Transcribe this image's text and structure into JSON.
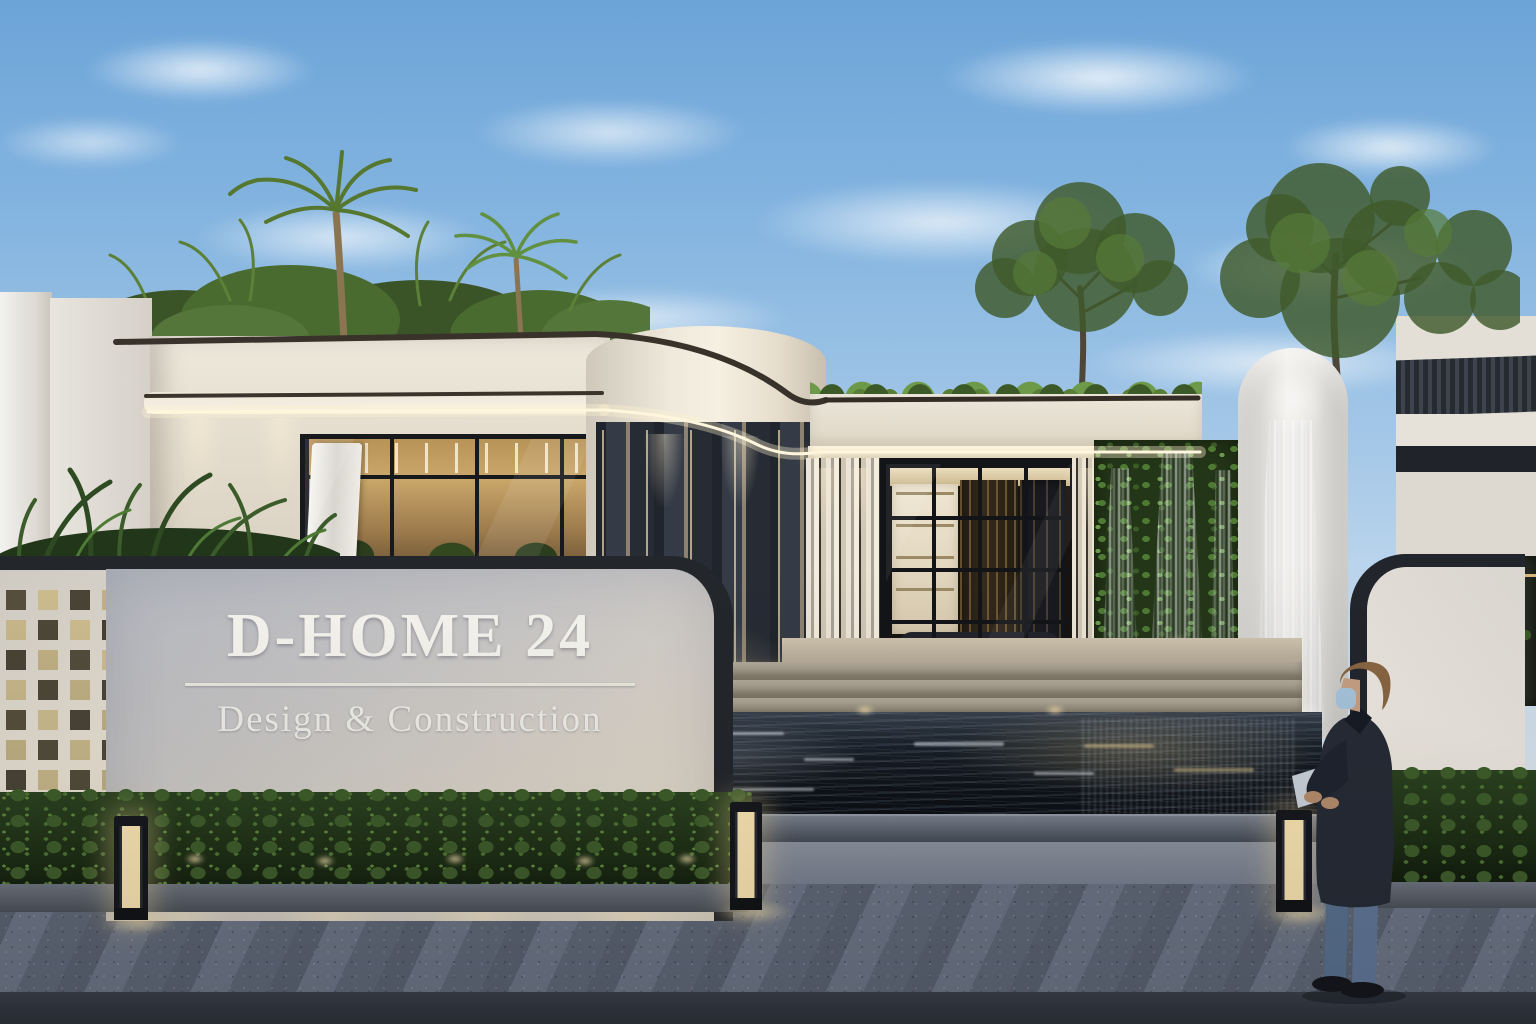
{
  "scene": {
    "description": "Dusk architectural exterior rendering: modern white curved office building with entrance reflecting pond, waterfall green wall, roof garden and illuminated signage wall",
    "lighting": "evening / dusk with warm accent lighting"
  },
  "signage": {
    "brand": "D-HOME 24",
    "tagline": "Design & Construction"
  },
  "palette": {
    "sky_top": "#6CA4D8",
    "sky_horizon": "#E8EEF2",
    "facade_white": "#F0EAE0",
    "trim_dark": "#2B2823",
    "warm_light": "#FFEDC2",
    "foliage": "#4E7434",
    "water": "#141A20",
    "pavement": "#6B7383",
    "denim_blue": "#5B7390",
    "mask_blue": "#A9C6DD"
  }
}
